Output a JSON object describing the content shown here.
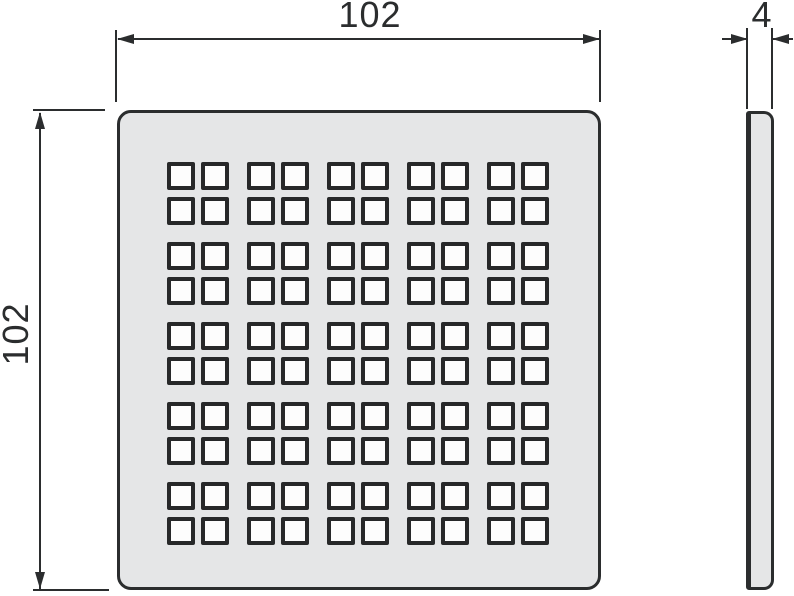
{
  "drawing": {
    "views": {
      "front": "perforated-square-grate-front-view",
      "side": "grate-side-profile"
    },
    "dimensions": {
      "width": {
        "label": "102"
      },
      "height": {
        "label": "102"
      },
      "thickness": {
        "label": "4"
      }
    },
    "grate": {
      "cluster_rows": 5,
      "cluster_cols": 5,
      "cluster_inner_rows": 2,
      "cluster_inner_cols": 2,
      "hole_total": 100
    },
    "colors": {
      "line": "#2b2d2e",
      "plate_fill": "#e5e6e7",
      "hole_fill": "#fdfdfd",
      "hole_border": "#272829",
      "background": "#ffffff"
    }
  }
}
